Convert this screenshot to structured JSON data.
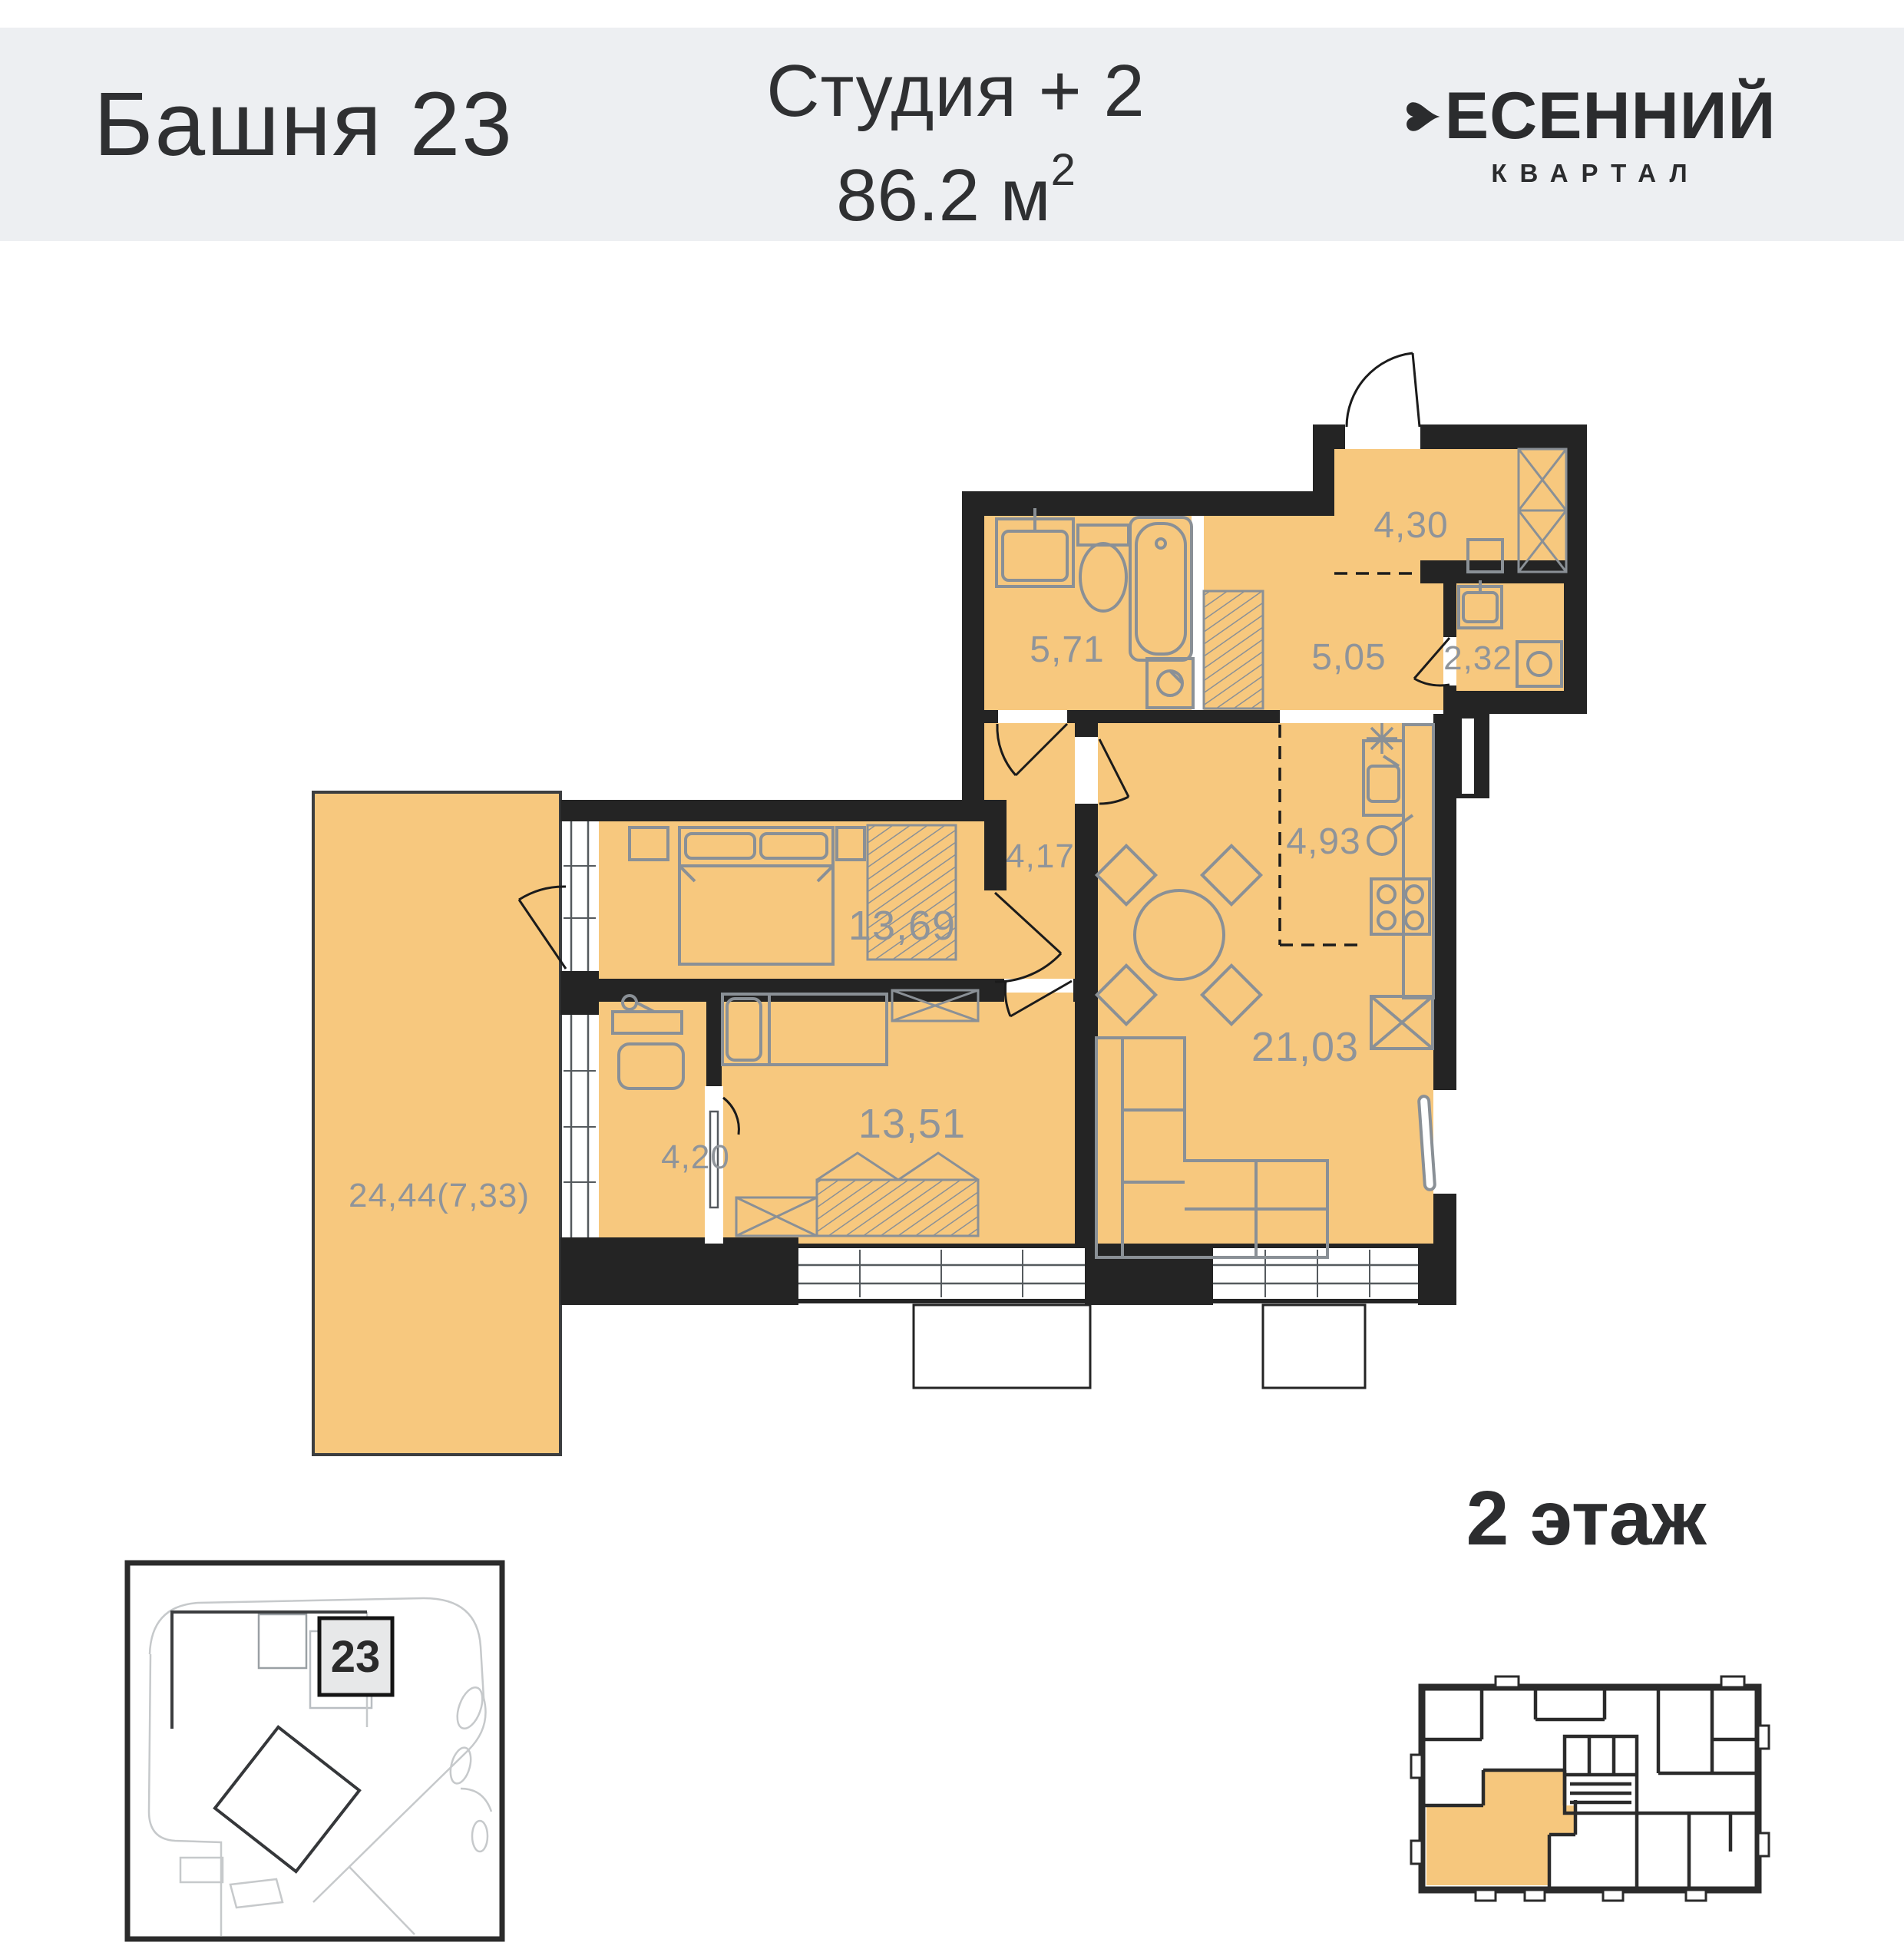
{
  "header": {
    "tower": "Башня 23",
    "unit_type": "Студия + 2",
    "area_main": "86.2 м",
    "area_sup": "2",
    "brand_top": "ЕСЕННИЙ",
    "brand_sub": "КВАРТАЛ",
    "brand_mark_icon": "heart-icon"
  },
  "plan": {
    "rooms": {
      "bathroom": "5,71",
      "entry_hall": "5,05",
      "loggia": "4,30",
      "wc": "2,32",
      "corridor": "4,17",
      "kitchen": "4,93",
      "living": "21,03",
      "bedroom_1": "13,69",
      "bedroom_2": "13,51",
      "nook": "4,20",
      "terrace": "24,44(7,33)"
    },
    "total_area_value": "86.2",
    "unit_type": "Студия + 2"
  },
  "site": {
    "badge": "23"
  },
  "floor": {
    "title": "2 этаж"
  },
  "colors": {
    "room_fill": "#f7c87e",
    "wall": "#242424",
    "furniture": "#8a9096",
    "header_bg": "#edeff2",
    "label": "#8f949a"
  }
}
